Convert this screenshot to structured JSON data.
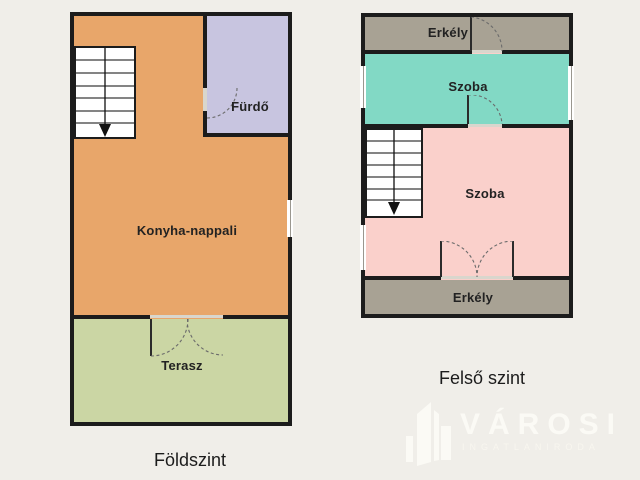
{
  "page": {
    "background_color": "#f0eee9",
    "wall_color": "#1c1c1c"
  },
  "ground_floor": {
    "caption": "Földszint",
    "rooms": {
      "kitchen_living": {
        "label": "Konyha-nappali",
        "color": "#e8a66a"
      },
      "bathroom": {
        "label": "Fürdő",
        "color": "#c8c5e0"
      },
      "terrace": {
        "label": "Terasz",
        "color": "#cbd6a4"
      }
    }
  },
  "upper_floor": {
    "caption": "Felső szint",
    "rooms": {
      "balcony_top": {
        "label": "Erkély",
        "color": "#a8a294"
      },
      "room_upper": {
        "label": "Szoba",
        "color": "#82d9c5"
      },
      "room_lower": {
        "label": "Szoba",
        "color": "#fad0cb"
      },
      "balcony_bottom": {
        "label": "Erkély",
        "color": "#a8a294"
      }
    }
  },
  "logo": {
    "brand": "VÁROSI",
    "subtitle": "INGATLANIRODA",
    "color": "#fbfaf5"
  }
}
